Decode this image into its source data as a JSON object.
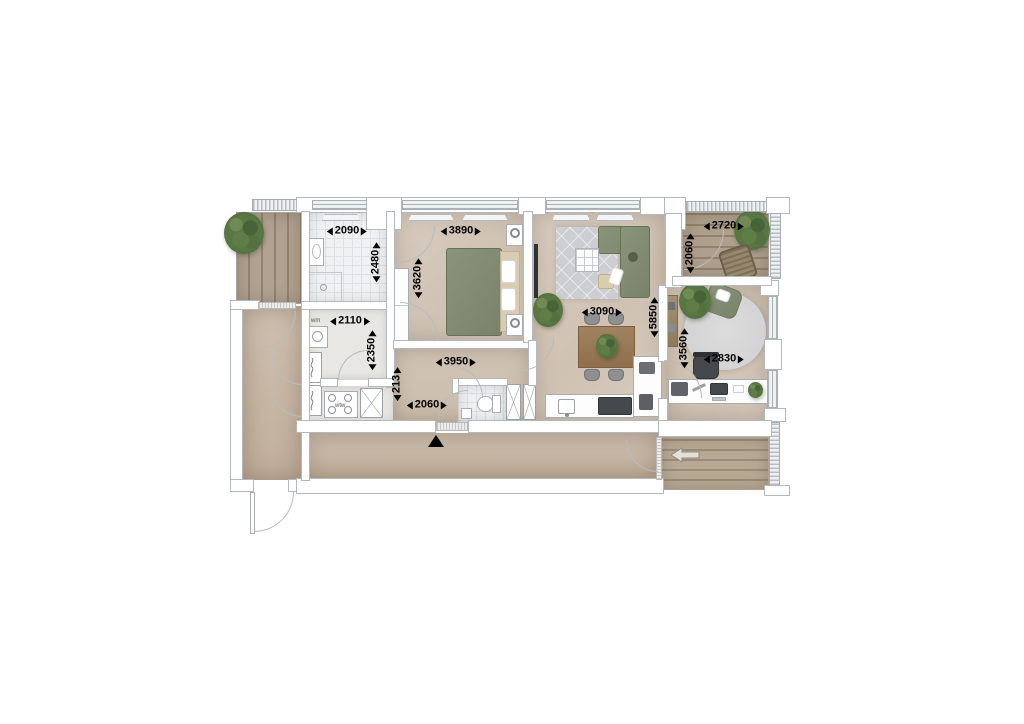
{
  "drawing": {
    "type": "apartment-floor-plan"
  },
  "labels": {
    "washing_machine": "wm",
    "heat_recovery_unit": "wtw"
  },
  "dimensions": {
    "bathroom_width": "2090",
    "bathroom_depth": "2480",
    "utility_width": "2110",
    "utility_depth": "2350",
    "bedroom_width": "3890",
    "bedroom_depth": "3620",
    "hall_width": "3950",
    "hall_niche": "213",
    "entrance_width": "2060",
    "living_width": "3090",
    "living_depth": "5850",
    "terrace_top_width": "2720",
    "terrace_top_depth": "2060",
    "study_depth": "3560",
    "study_width": "2830"
  },
  "icons": {
    "north_marker": "triangle-up",
    "entry_arrow": "arrow-left",
    "shaft": "x-cross",
    "meter_cabinet": "zigzag"
  },
  "colors": {
    "wall_outline": "#b3b8bc",
    "floor": "#d4c8ba",
    "corridor": "#c8b8a7",
    "deck_wood": "#a89a87",
    "tile": "#eff1f2",
    "sofa_green": "#818c71",
    "wood_brown": "#9a7a58",
    "plant_green": "#567341",
    "dimension_text": "#000000"
  }
}
